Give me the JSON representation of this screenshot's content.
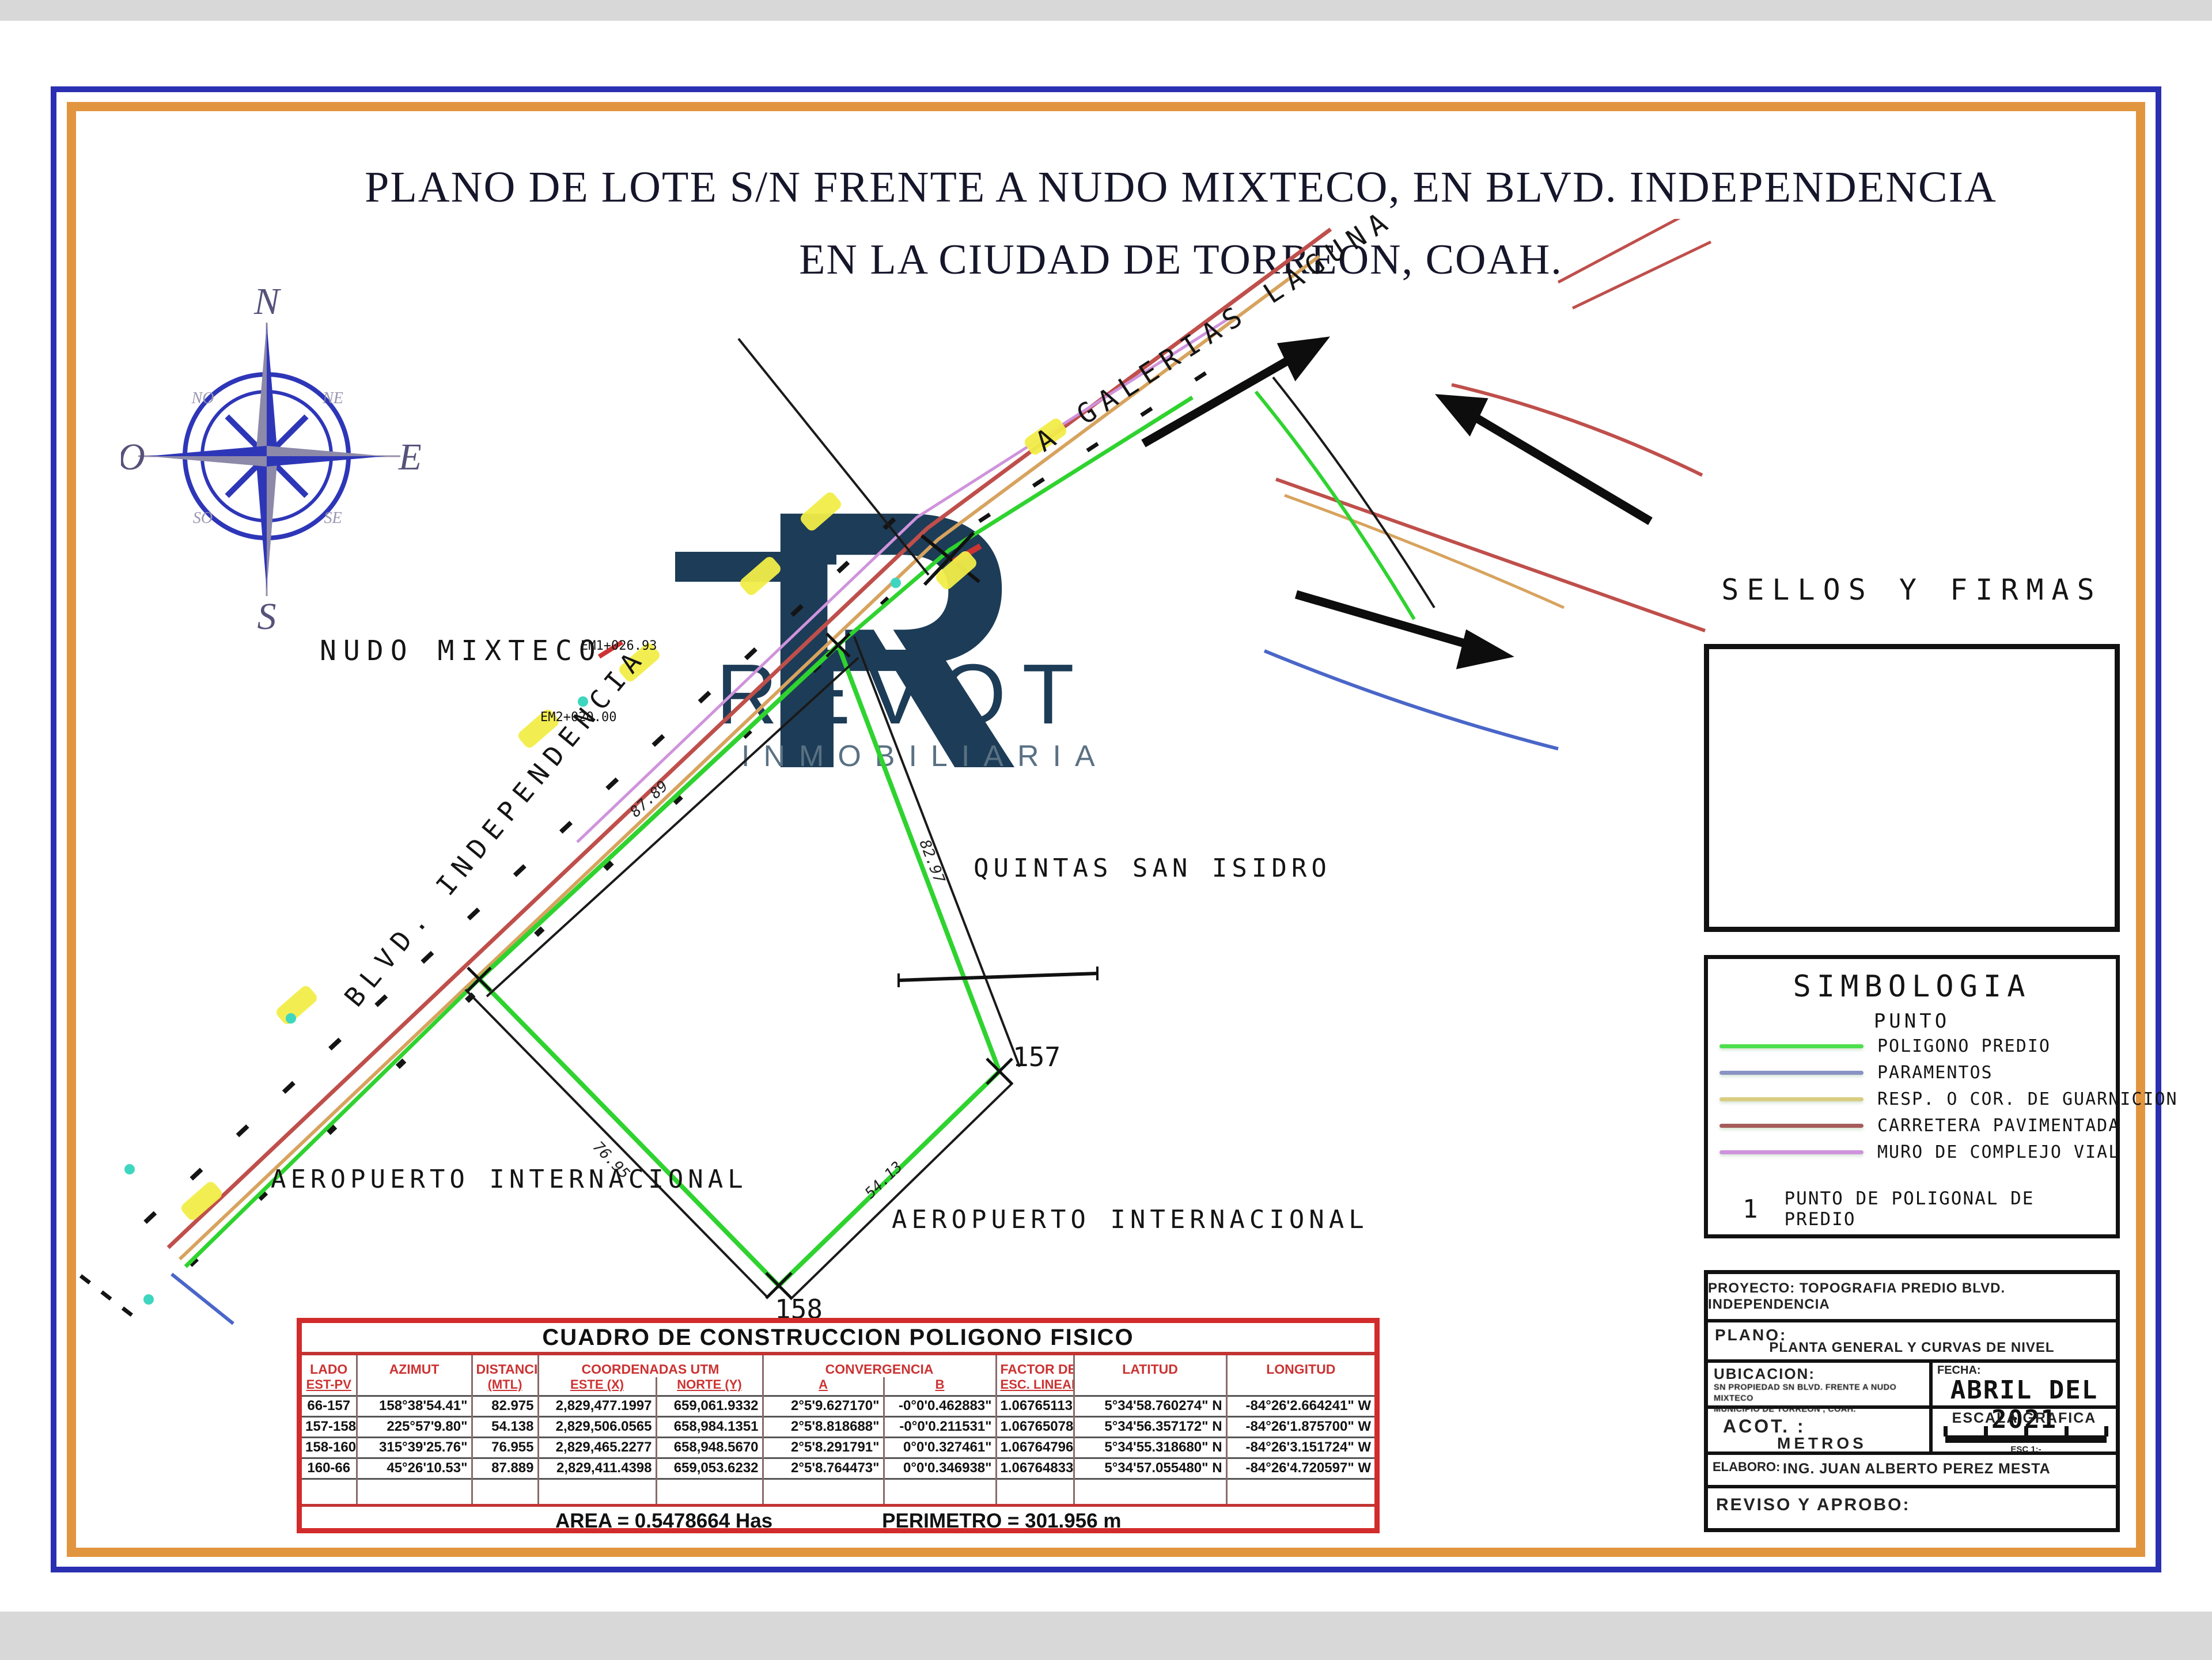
{
  "page": {
    "title_line1": "PLANO DE LOTE S/N FRENTE A NUDO MIXTECO, EN BLVD. INDEPENDENCIA",
    "title_line2": "EN LA CIUDAD DE TORREON, COAH."
  },
  "compass": {
    "n": "N",
    "s": "S",
    "e": "E",
    "o": "O",
    "ne": "NE",
    "no": "NO",
    "se": "SE",
    "so": "SO"
  },
  "watermark": {
    "monogram": "R",
    "inner": "R",
    "name": "REVOT",
    "subtitle": "INMOBILIARIA",
    "navy": "#1d3c57",
    "gray": "#5a7183"
  },
  "map": {
    "labels": {
      "nudo_mixteco": "NUDO MIXTECO",
      "blvd_independencia": "BLVD. INDEPENDENCIA",
      "quintas_san_isidro": "QUINTAS SAN ISIDRO",
      "aeropuerto_left": "AEROPUERTO INTERNACIONAL",
      "aeropuerto_right": "AEROPUERTO INTERNACIONAL",
      "a_galerias_laguna": "A GALERIAS LAGUNA",
      "point_157": "157",
      "point_158": "158",
      "station_1": "EM1+026.93",
      "station_2": "EM2+020.00",
      "dist_66_157": "82.97",
      "dist_157_158": "54.13",
      "dist_158_160": "76.95",
      "dist_160_66": "87.89"
    },
    "colors": {
      "poligono_predio": "#2fd32f",
      "paramentos": "#4a66c8",
      "guarnicion": "#d7a35e",
      "carretera": "#bf4f4b",
      "muro_vial": "#cf93dc",
      "resalte": "#f2ee49",
      "survey": "#1a1a1a",
      "teal": "#3fd6c0"
    }
  },
  "sellos": {
    "title": "SELLOS Y FIRMAS"
  },
  "simbologia": {
    "title": "SIMBOLOGIA",
    "subtitle": "PUNTO",
    "items": [
      {
        "label": "POLIGONO PREDIO",
        "color": "#4ce04c"
      },
      {
        "label": "PARAMENTOS",
        "color": "#8a93c4"
      },
      {
        "label": "RESP. O COR. DE GUARNICION",
        "color": "#d9cd82"
      },
      {
        "label": "CARRETERA PAVIMENTADA",
        "color": "#a65b5b"
      },
      {
        "label": "MURO DE COMPLEJO VIAL",
        "color": "#cf93dc"
      }
    ],
    "point_symbol": "1",
    "point_label": "PUNTO DE POLIGONAL DE PREDIO"
  },
  "titleblock": {
    "proyecto": "PROYECTO: TOPOGRAFIA PREDIO BLVD. INDEPENDENCIA",
    "plano_label": "PLANO:",
    "plano_value": "PLANTA GENERAL Y CURVAS DE NIVEL",
    "ubicacion_label": "UBICACION:",
    "ubicacion_line1": "SN PROPIEDAD SN BLVD. FRENTE A NUDO MIXTECO",
    "ubicacion_line2": "MUNICIPIO DE TORREON , COAH.",
    "fecha_label": "FECHA:",
    "fecha_value": "ABRIL DEL 2021",
    "acot_label": "ACOT. :",
    "acot_value": "METROS",
    "escala_label": "ESCALA GRAFICA",
    "escala_caption": "ESC 1:-",
    "elaboro_label": "ELABORO:",
    "elaboro_value": "ING. JUAN ALBERTO PEREZ MESTA",
    "reviso_label": "REVISO Y APROBO:"
  },
  "cuadro": {
    "title": "CUADRO DE CONSTRUCCION POLIGONO FISICO",
    "headers": {
      "lado_1": "LADO",
      "lado_2": "EST-PV",
      "azimut": "AZIMUT",
      "dist_1": "DISTANCIA",
      "dist_2": "(MTL)",
      "coord_group": "COORDENADAS UTM",
      "este": "ESTE (X)",
      "norte": "NORTE (Y)",
      "conv_group": "CONVERGENCIA",
      "conv_a": "A",
      "conv_b": "B",
      "factor_1": "FACTOR DE",
      "factor_2": "ESC. LINEAL",
      "latitud": "LATITUD",
      "longitud": "LONGITUD"
    },
    "rows": [
      {
        "lado": "66-157",
        "azimut": "158°38'54.41\"",
        "dist": "82.975",
        "este": "2,829,477.1997",
        "norte": "659,061.9332",
        "conv_a": "2°5'9.627170\"",
        "conv_b": "-0°0'0.462883\"",
        "factor": "1.06765113",
        "lat": "5°34'58.760274\" N",
        "lon": "-84°26'2.664241\" W"
      },
      {
        "lado": "157-158",
        "azimut": "225°57'9.80\"",
        "dist": "54.138",
        "este": "2,829,506.0565",
        "norte": "658,984.1351",
        "conv_a": "2°5'8.818688\"",
        "conv_b": "-0°0'0.211531\"",
        "factor": "1.06765078",
        "lat": "5°34'56.357172\" N",
        "lon": "-84°26'1.875700\" W"
      },
      {
        "lado": "158-160",
        "azimut": "315°39'25.76\"",
        "dist": "76.955",
        "este": "2,829,465.2277",
        "norte": "658,948.5670",
        "conv_a": "2°5'8.291791\"",
        "conv_b": "0°0'0.327461\"",
        "factor": "1.06764796",
        "lat": "5°34'55.318680\" N",
        "lon": "-84°26'3.151724\" W"
      },
      {
        "lado": "160-66",
        "azimut": "45°26'10.53\"",
        "dist": "87.889",
        "este": "2,829,411.4398",
        "norte": "659,053.6232",
        "conv_a": "2°5'8.764473\"",
        "conv_b": "0°0'0.346938\"",
        "factor": "1.06764833",
        "lat": "5°34'57.055480\" N",
        "lon": "-84°26'4.720597\" W"
      }
    ],
    "area": "AREA = 0.5478664 Has",
    "perimetro": "PERIMETRO = 301.956 m"
  }
}
